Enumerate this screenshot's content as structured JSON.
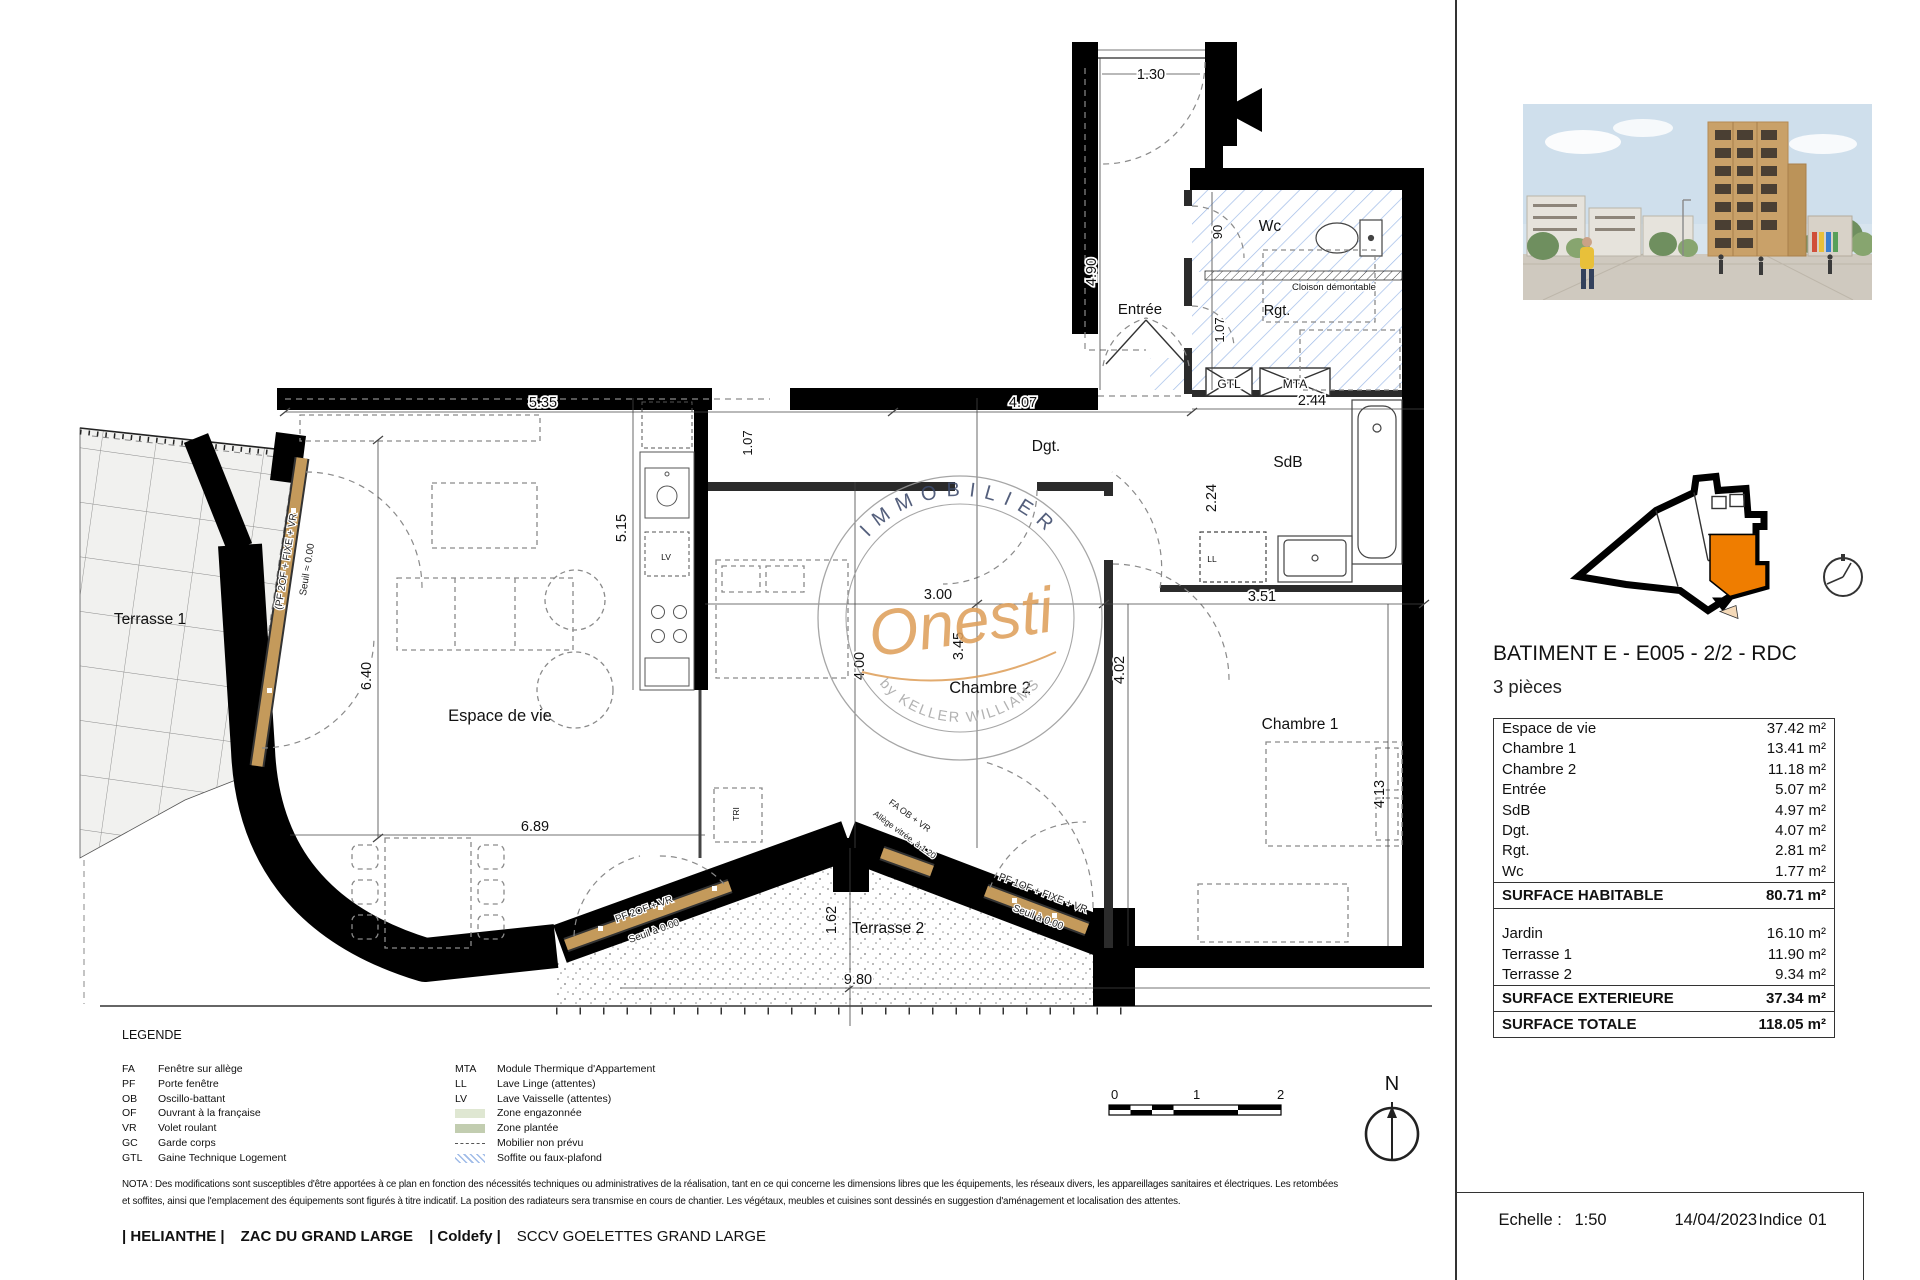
{
  "colors": {
    "accent_orange": "#EF7D00",
    "watermark_orange": "#DFA05C",
    "window_wood": "#C49A5B",
    "hatch_blue": "#9FBBE8",
    "wall": "#000000"
  },
  "plan": {
    "labels": {
      "terrasse1": "Terrasse 1",
      "espace": "Espace de vie",
      "entree": "Entrée",
      "wc": "Wc",
      "rgt": "Rgt.",
      "dgt": "Dgt.",
      "sdb": "SdB",
      "chambre2": "Chambre 2",
      "chambre1": "Chambre 1",
      "terrasse2": "Terrasse 2",
      "gtl": "GTL",
      "mta": "MTA",
      "ll": "LL",
      "lv": "LV",
      "tri": "TRI",
      "cloison": "Cloison démontable"
    },
    "dims": [
      "1.30",
      "4.90",
      "90",
      "1.07",
      "5.35",
      "4.07",
      "1.07",
      "2.44",
      "2.24",
      "3.51",
      "3.00",
      "3.45",
      "4.00",
      "5.15",
      "6.40",
      "6.89",
      "4.02",
      "4.13",
      "1.62",
      "9.80"
    ],
    "openings": {
      "t1a": "(PF 2OF + FIXE + VR",
      "t1b": "Seuil ≈ 0.00",
      "d1a": "PF 2OF + VR",
      "d1b": "Seuil à 0.00",
      "w2a": "FA OB + VR",
      "w2b": "Allège vitrée. à 1.20",
      "d2a": "PF 1OF + FIXE + VR",
      "d2b": "Seuil à 0.00"
    },
    "watermark": {
      "top": "IMMOBILIER",
      "script": "Onesti",
      "bottom": "by KELLER WILLIAMS"
    }
  },
  "sidebar": {
    "title": "BATIMENT E - E005 - 2/2 - RDC",
    "subtitle": "3 pièces",
    "table": {
      "rows": [
        {
          "label": "Espace de vie",
          "value": "37.42 m²"
        },
        {
          "label": "Chambre 1",
          "value": "13.41 m²"
        },
        {
          "label": "Chambre 2",
          "value": "11.18 m²"
        },
        {
          "label": "Entrée",
          "value": "5.07 m²"
        },
        {
          "label": "SdB",
          "value": "4.97 m²"
        },
        {
          "label": "Dgt.",
          "value": "4.07 m²"
        },
        {
          "label": "Rgt.",
          "value": "2.81 m²"
        },
        {
          "label": "Wc",
          "value": "1.77 m²"
        }
      ],
      "habitable": {
        "label": "SURFACE HABITABLE",
        "value": "80.71 m²"
      },
      "ext_rows": [
        {
          "label": "Jardin",
          "value": "16.10 m²"
        },
        {
          "label": "Terrasse 1",
          "value": "11.90 m²"
        },
        {
          "label": "Terrasse 2",
          "value": "9.34 m²"
        }
      ],
      "exterieure": {
        "label": "SURFACE EXTERIEURE",
        "value": "37.34 m²"
      },
      "totale": {
        "label": "SURFACE TOTALE",
        "value": "118.05 m²"
      }
    }
  },
  "legend": {
    "title": "LEGENDE",
    "left": [
      {
        "abbr": "FA",
        "label": "Fenêtre sur allège"
      },
      {
        "abbr": "PF",
        "label": "Porte fenêtre"
      },
      {
        "abbr": "OB",
        "label": "Oscillo-battant"
      },
      {
        "abbr": "OF",
        "label": "Ouvrant à la française"
      },
      {
        "abbr": "VR",
        "label": "Volet roulant"
      },
      {
        "abbr": "GC",
        "label": "Garde corps"
      },
      {
        "abbr": "GTL",
        "label": "Gaine Technique Logement"
      }
    ],
    "right": [
      {
        "abbr": "MTA",
        "label": "Module Thermique d'Appartement"
      },
      {
        "abbr": "LL",
        "label": "Lave Linge (attentes)"
      },
      {
        "abbr": "LV",
        "label": "Lave Vaisselle (attentes)"
      },
      {
        "abbr": "",
        "label": "Zone engazonnée"
      },
      {
        "abbr": "",
        "label": "Zone plantée"
      },
      {
        "abbr": "",
        "label": "Mobilier non prévu"
      },
      {
        "abbr": "",
        "label": "Soffite ou faux-plafond"
      }
    ]
  },
  "nota": {
    "line1": "NOTA : Des modifications sont susceptibles d'être apportées à ce plan en fonction des nécessités techniques ou administratives de la réalisation, tant en ce qui concerne les dimensions libres que les équipements, les réseaux divers, les appareillages sanitaires et électriques. Les retombées",
    "line2": "et soffites, ainsi que l'emplacement des équipements sont figurés à titre indicatif. La position des radiateurs sera transmise en cours de chantier. Les végétaux, meubles et cuisines sont dessinés en suggestion d'aménagement et localisation des attentes."
  },
  "footer": {
    "p1": "| HELIANTHE |",
    "p2": "ZAC DU GRAND LARGE",
    "p3": "| Coldefy |",
    "p4": "SCCV GOELETTES GRAND LARGE"
  },
  "titleblock": {
    "echelle_label": "Echelle :",
    "echelle": "1:50",
    "date": "14/04/2023",
    "indice_label": "Indice",
    "indice": "01"
  },
  "scalebar": {
    "t0": "0",
    "t1": "1",
    "t2": "2"
  },
  "north": {
    "label": "N"
  }
}
